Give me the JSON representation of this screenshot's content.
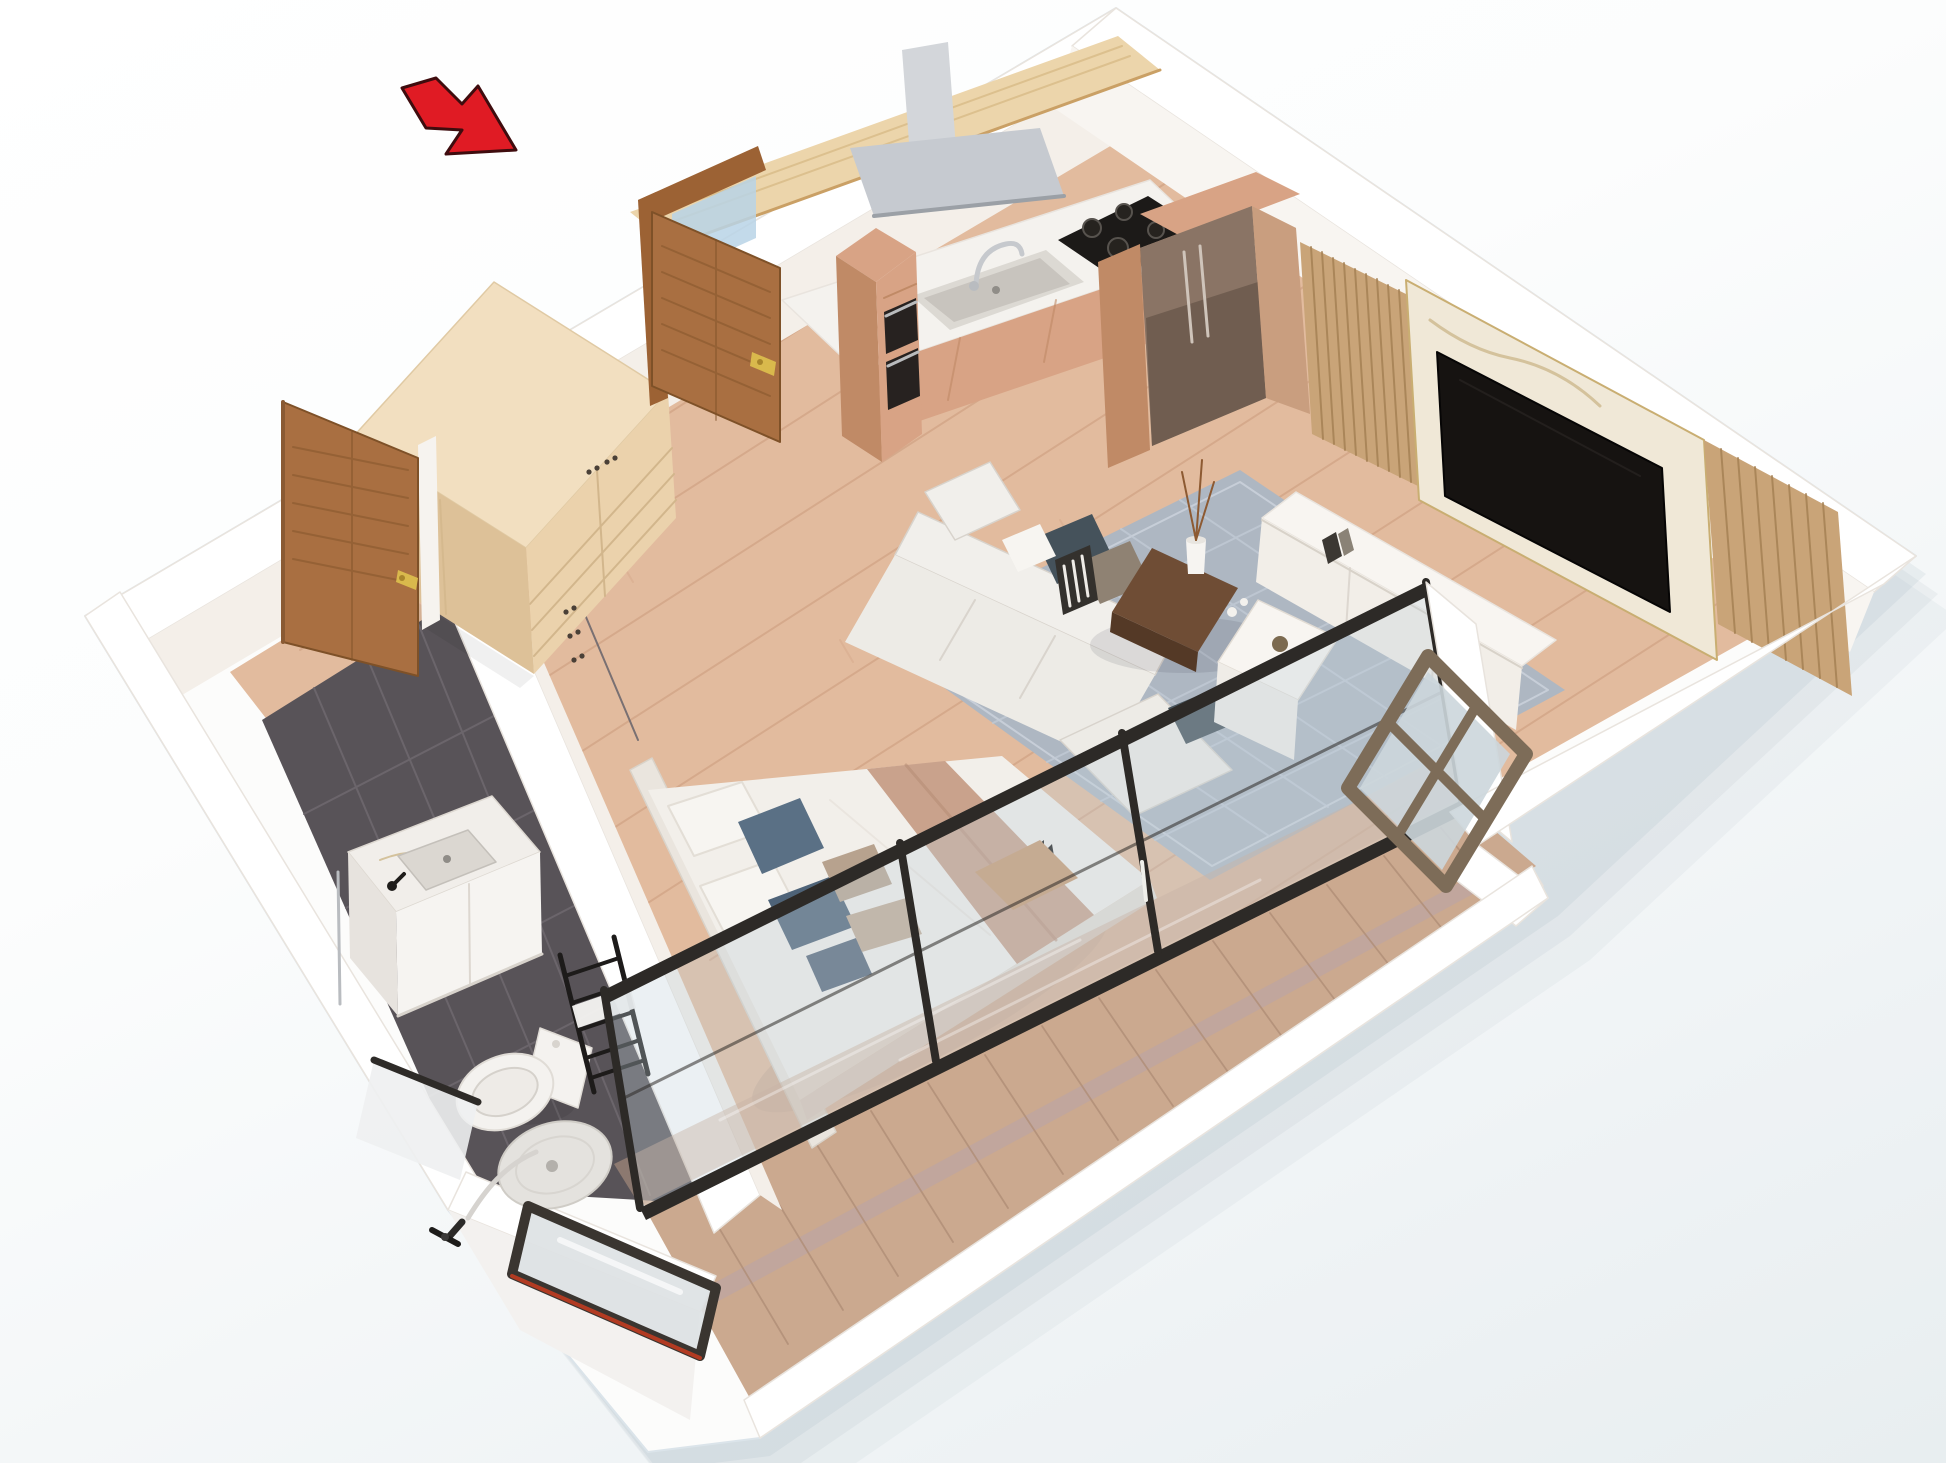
{
  "meta": {
    "type": "isometric-3d-floor-plan-render",
    "subject": "studio apartment cutaway",
    "visible_text": []
  },
  "scene": {
    "rooms": [
      "entrance",
      "kitchen",
      "living-area",
      "sleeping-area",
      "bathroom",
      "balcony"
    ],
    "objects": [
      "entrance-door",
      "entrance-arrow",
      "wardrobe",
      "kitchen-counter",
      "sink",
      "faucet",
      "gas-hob",
      "cooker-hood",
      "wall-shelf",
      "oven-tower",
      "fridge",
      "tv",
      "tv-marble-panel",
      "wood-slat-panels",
      "media-console",
      "sofa",
      "cushions",
      "rug",
      "coffee-table",
      "side-table",
      "bed",
      "pillows",
      "bed-throw",
      "headboard-wall",
      "glass-sliding-wall",
      "balcony-floor",
      "balcony-bench",
      "casement-window",
      "bathroom-door",
      "vanity",
      "wash-basin",
      "toilet",
      "towel-ladder",
      "shower-tray",
      "hand-shower",
      "shower-screen",
      "shower-side-panel"
    ],
    "annotations": {
      "entrance_arrow_meaning": "entrance-direction"
    }
  },
  "colors": {
    "shadow": "#8fa6b2",
    "shell": "#fcfcfb",
    "wall_top": "#ffffff",
    "wall_face": "#f4efe9",
    "wall_face_lit": "#f8f5f1",
    "wall_face_dark": "#e9e1d9",
    "wood_floor": "#e2bb9e",
    "wood_line": "#cfa081",
    "bath_floor": "#585358",
    "bath_grout": "#6e686e",
    "balcony_floor": "#cba98f",
    "balcony_line": "#b08e77",
    "rug": "#aeb7c2",
    "cabinet": "#d8a385",
    "cabinet_dark": "#c08a66",
    "counter": "#f4f2ee",
    "steel": "#c6cad0",
    "steel_light": "#d3d6da",
    "hob": "#1c1a18",
    "oven": "#272220",
    "shelf": "#ecd5ab",
    "fridge": "#8a7465",
    "fridge_dark": "#6b594c",
    "fridge_side": "#c99e7f",
    "door": "#a96f41",
    "door_frame": "#9c6234",
    "door_dark": "#7e5128",
    "gold": "#d9b94c",
    "glass_blue": "#b9d3e6",
    "wardrobe": "#ebd2ac",
    "wardrobe_top": "#f2dfc0",
    "wardrobe_side": "#ddc198",
    "knob": "#4a4037",
    "slat": "#c9a478",
    "marble": "#f0e8d7",
    "tv": "#161311",
    "console": "#f8f5f1",
    "console_front": "#f2eee8",
    "sofa": "#edebe6",
    "sofa_light": "#f1efeb",
    "cushion_dark": "#45525b",
    "cushion_taupe": "#8f8273",
    "table": "#6f4d35",
    "table_dark": "#543926",
    "bed": "#f2efea",
    "bed_shade": "#e3ddd5",
    "throw": "#c9a28c",
    "pillow_white": "#f7f5f1",
    "pillow_blue": "#5a7085",
    "pillow_blue2": "#4e6378",
    "pillow_blue3": "#56667a",
    "pillow_taupe": "#b7a28e",
    "pillow_taupe2": "#c2ab96",
    "headboard": "#eae5de",
    "frame_dark": "#2d2a27",
    "glass_tint": "rgba(193,208,219,0.32)",
    "window_frame": "#7d6c58",
    "window_glass": "#ccd6db",
    "fixture": "#f4f2ef",
    "ladder": "#1d1b1a",
    "bench": "#c89a71",
    "screen_glass": "#dde2e4",
    "screen_frame": "#3a3530",
    "screen_red": "#b23b22",
    "red": "#e01b24"
  }
}
